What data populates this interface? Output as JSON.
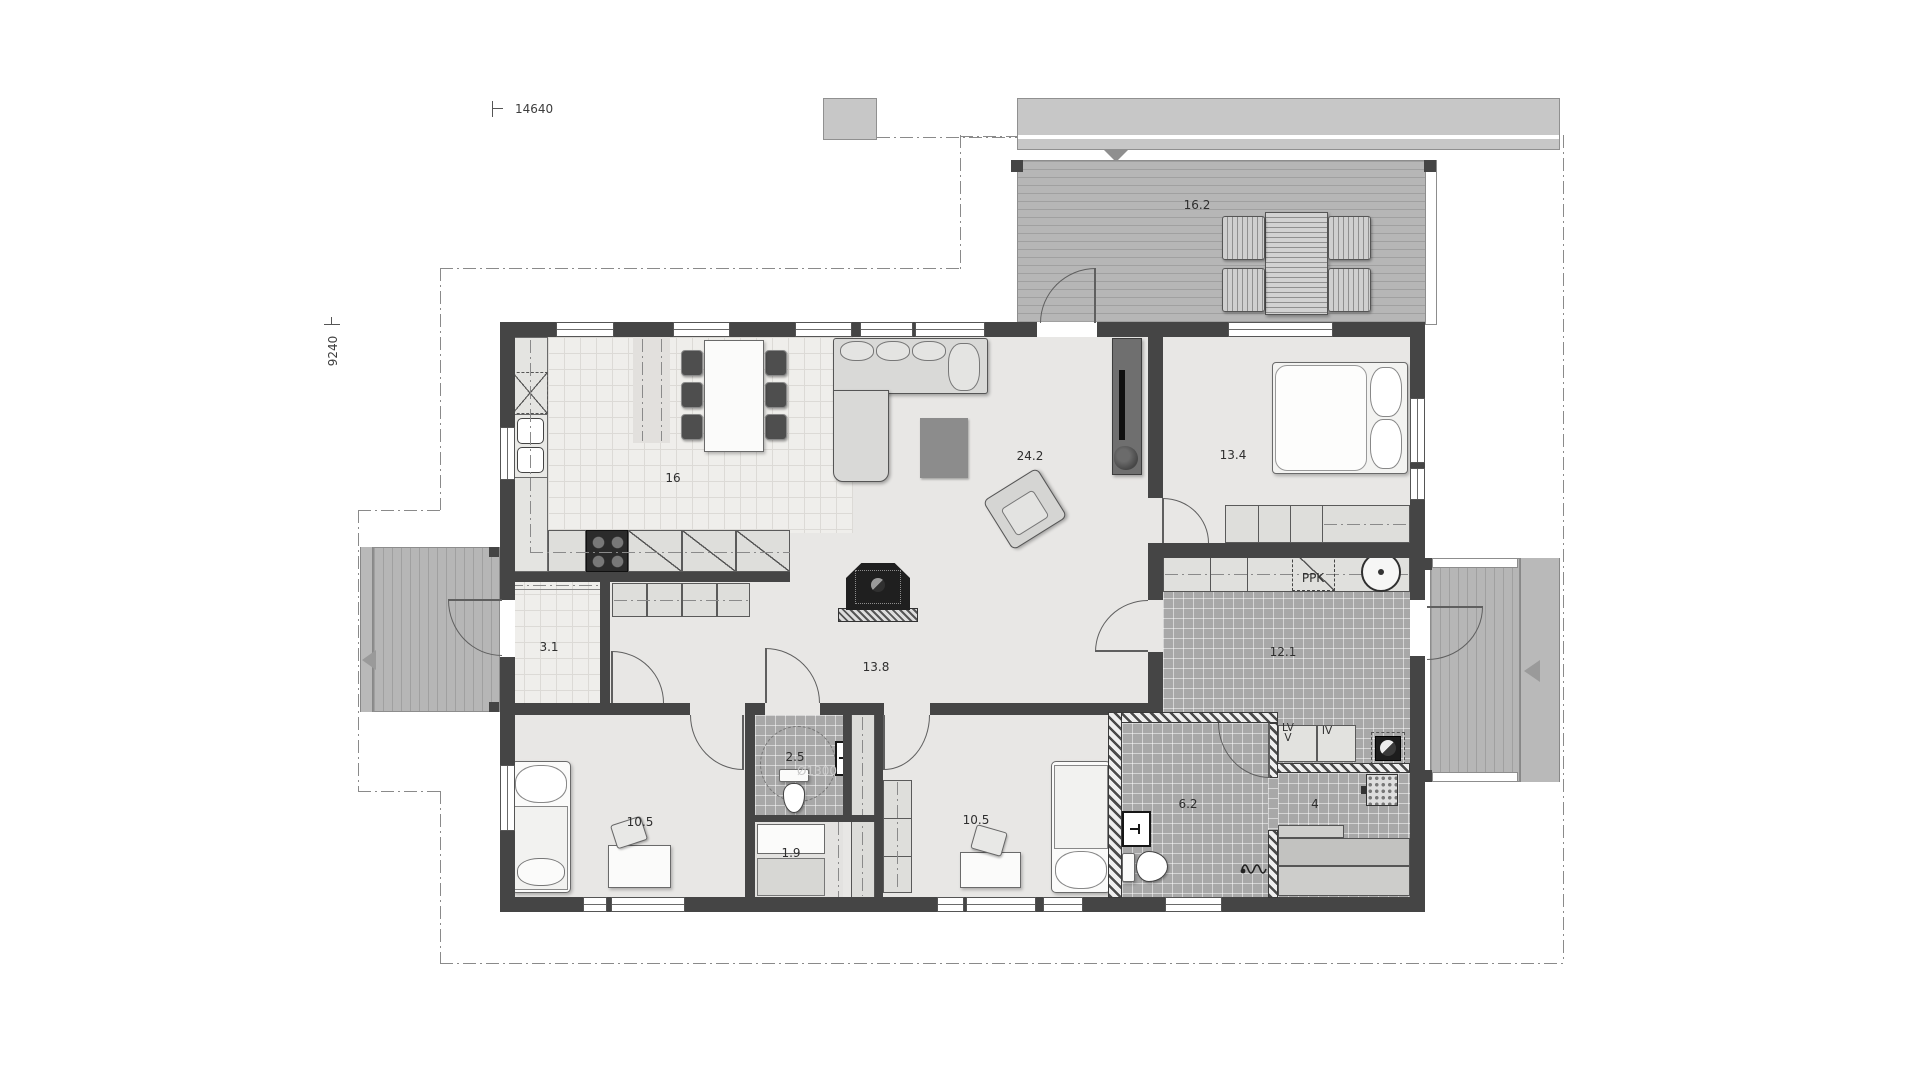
{
  "dimensions": {
    "width": "14640",
    "height": "9240"
  },
  "rooms": {
    "terrace": "16.2",
    "kitchen": "16",
    "living_room": "24.2",
    "master_bedroom": "13.4",
    "hallway": "13.8",
    "entry": "3.1",
    "utility_room": "12.1",
    "wc": "2.5",
    "closet": "1.9",
    "bedroom_left": "10.5",
    "bedroom_right": "10.5",
    "bathroom": "6.2",
    "sauna": "4"
  },
  "annotations": {
    "washing_machine": "PPK",
    "turning_circle": "Ø1300",
    "water_heater_line1": "LV",
    "water_heater_line2": "V",
    "ventilation_unit": "IV"
  }
}
